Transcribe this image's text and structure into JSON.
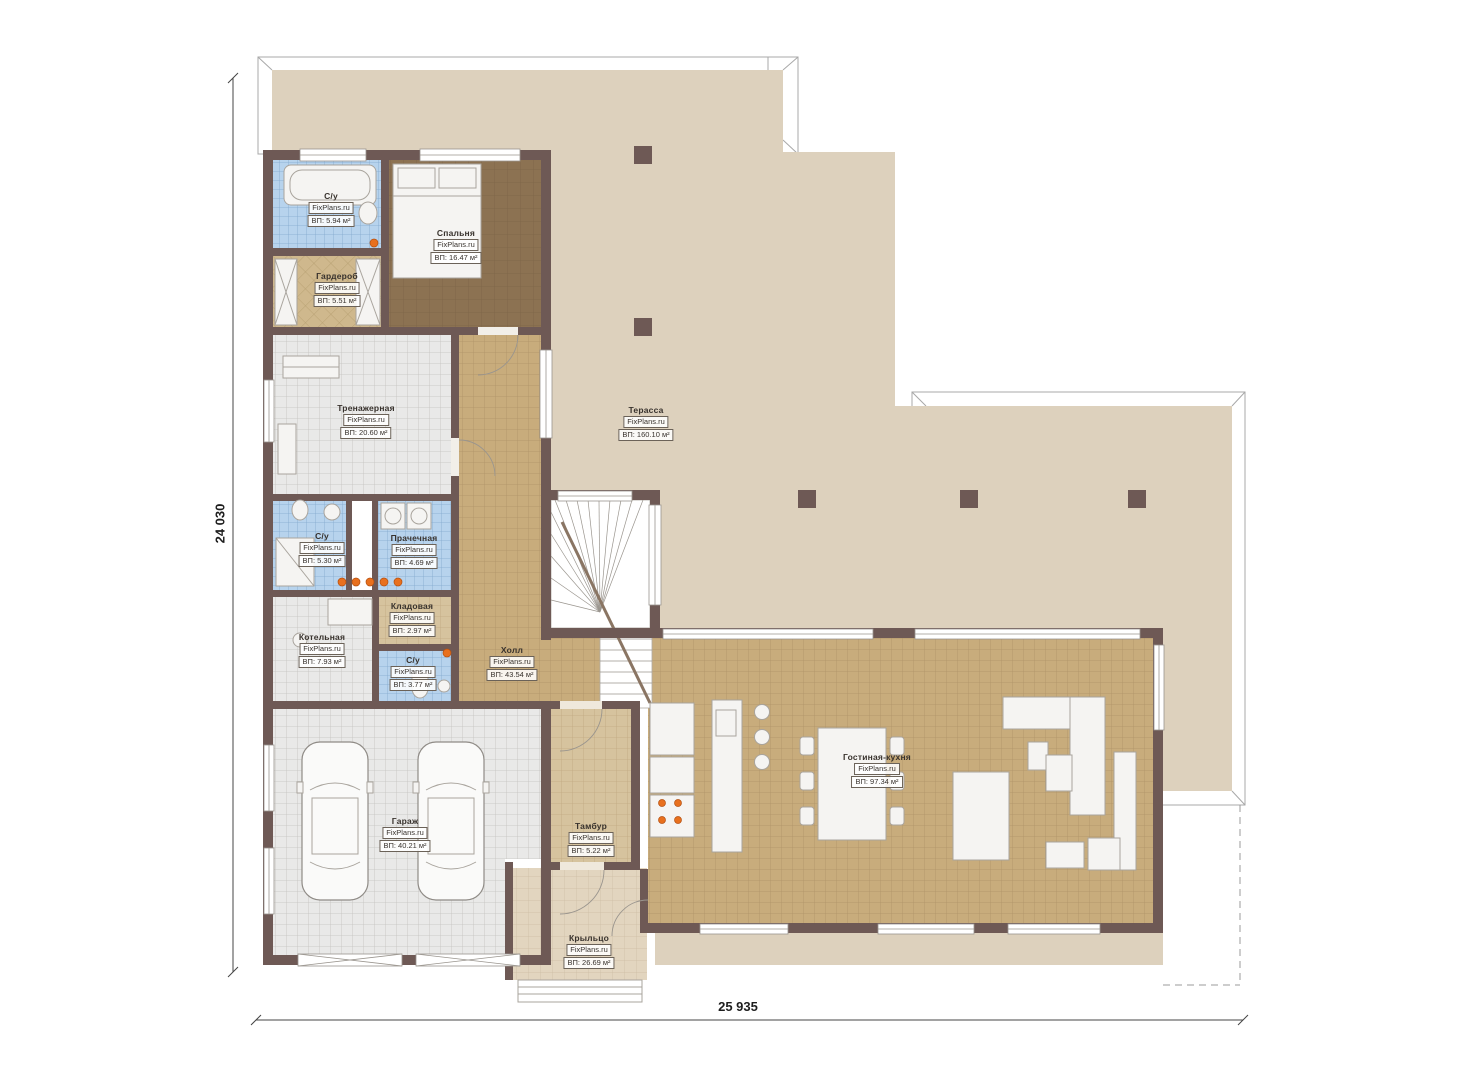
{
  "plan": {
    "kind": "first-floor plan",
    "watermark": "FixPlans.ru"
  },
  "dimensions": {
    "vertical": "24 030",
    "horizontal": "25 935"
  },
  "rooms": [
    {
      "name": "С/у",
      "watermark": "FixPlans.ru",
      "area": "ВП: 5.94 м²"
    },
    {
      "name": "Спальня",
      "watermark": "FixPlans.ru",
      "area": "ВП: 16.47 м²"
    },
    {
      "name": "Гардероб",
      "watermark": "FixPlans.ru",
      "area": "ВП: 5.51 м²"
    },
    {
      "name": "Тренажерная",
      "watermark": "FixPlans.ru",
      "area": "ВП: 20.60 м²"
    },
    {
      "name": "Терасса",
      "watermark": "FixPlans.ru",
      "area": "ВП: 160.10 м²"
    },
    {
      "name": "С/у",
      "watermark": "FixPlans.ru",
      "area": "ВП: 5.30 м²"
    },
    {
      "name": "Прачечная",
      "watermark": "FixPlans.ru",
      "area": "ВП: 4.69 м²"
    },
    {
      "name": "Кладовая",
      "watermark": "FixPlans.ru",
      "area": "ВП: 2.97 м²"
    },
    {
      "name": "Котельная",
      "watermark": "FixPlans.ru",
      "area": "ВП: 7.93 м²"
    },
    {
      "name": "С/у",
      "watermark": "FixPlans.ru",
      "area": "ВП: 3.77 м²"
    },
    {
      "name": "Холл",
      "watermark": "FixPlans.ru",
      "area": "ВП: 43.54 м²"
    },
    {
      "name": "Гараж",
      "watermark": "FixPlans.ru",
      "area": "ВП: 40.21 м²"
    },
    {
      "name": "Тамбур",
      "watermark": "FixPlans.ru",
      "area": "ВП: 5.22 м²"
    },
    {
      "name": "Гостиная-кухня",
      "watermark": "FixPlans.ru",
      "area": "ВП: 97.34 м²"
    },
    {
      "name": "Крыльцо",
      "watermark": "FixPlans.ru",
      "area": "ВП: 26.69 м²"
    }
  ],
  "colors": {
    "wall": "#6e5955",
    "terrace_floor": "#ddd1bd",
    "tile_tan": "#c8ac7c",
    "tile_gray": "#e9e9e8",
    "tile_blue": "#b7d3ed",
    "floor_brown": "#8c7252",
    "accent_orange": "#e8701e"
  }
}
